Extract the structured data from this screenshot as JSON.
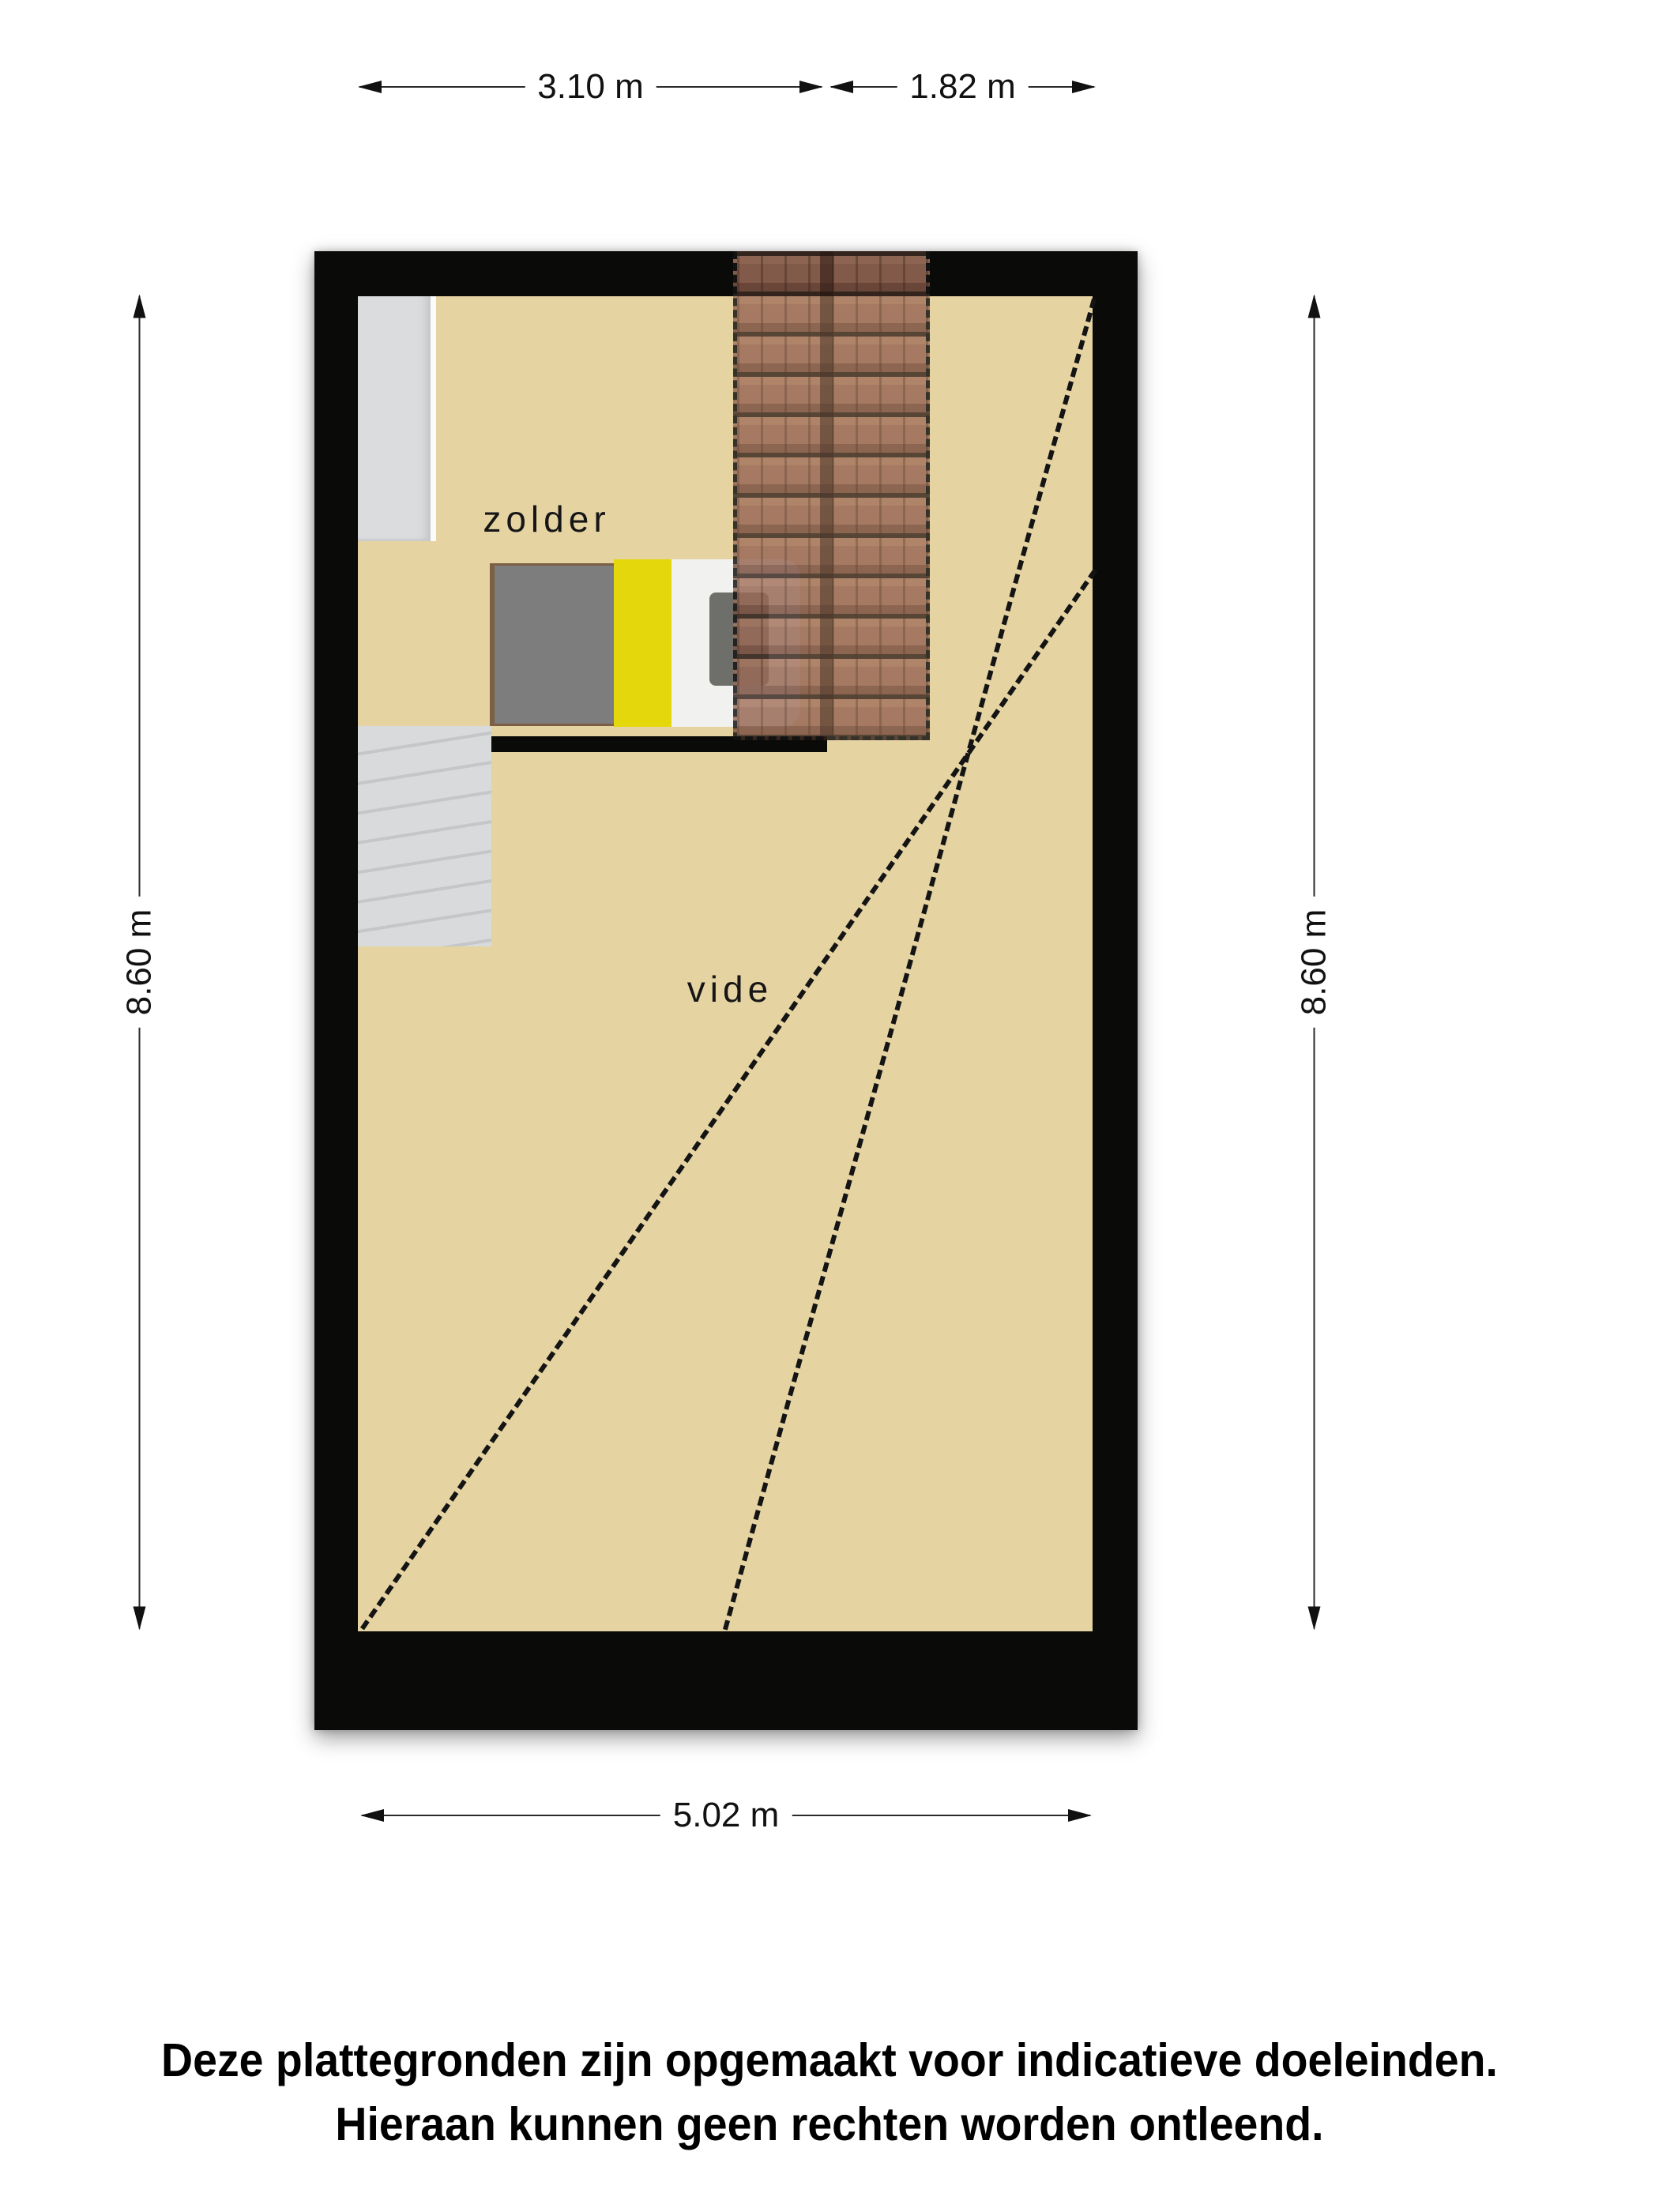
{
  "plan": {
    "room_labels": {
      "attic": "zolder",
      "void": "vide"
    },
    "dimensions": {
      "top_left_width": "3.10 m",
      "top_right_width": "1.82 m",
      "left_height": "8.60 m",
      "right_height": "8.60 m",
      "bottom_width": "5.02 m"
    }
  },
  "disclaimer": {
    "line1": "Deze plattegronden zijn opgemaakt voor indicatieve doeleinden.",
    "line2": "Hieraan kunnen geen rechten worden ontleend."
  },
  "colors": {
    "floor": "#e5d3a2",
    "wall": "#0a0a08",
    "roof_tiles": "#9a6a56",
    "roof_tile_line": "#3c2b22",
    "stairs": "#d6d7d9",
    "closet": "#dbdcde",
    "bed_gray": "#7d7d7d",
    "bed_yellow": "#e4d70b",
    "bed_white": "#f1f1ef",
    "bed_frame": "#7c5f45",
    "pillow": "#6e6f6b",
    "dashed_line": "#141414",
    "dimension_text": "#1a1a1a"
  }
}
